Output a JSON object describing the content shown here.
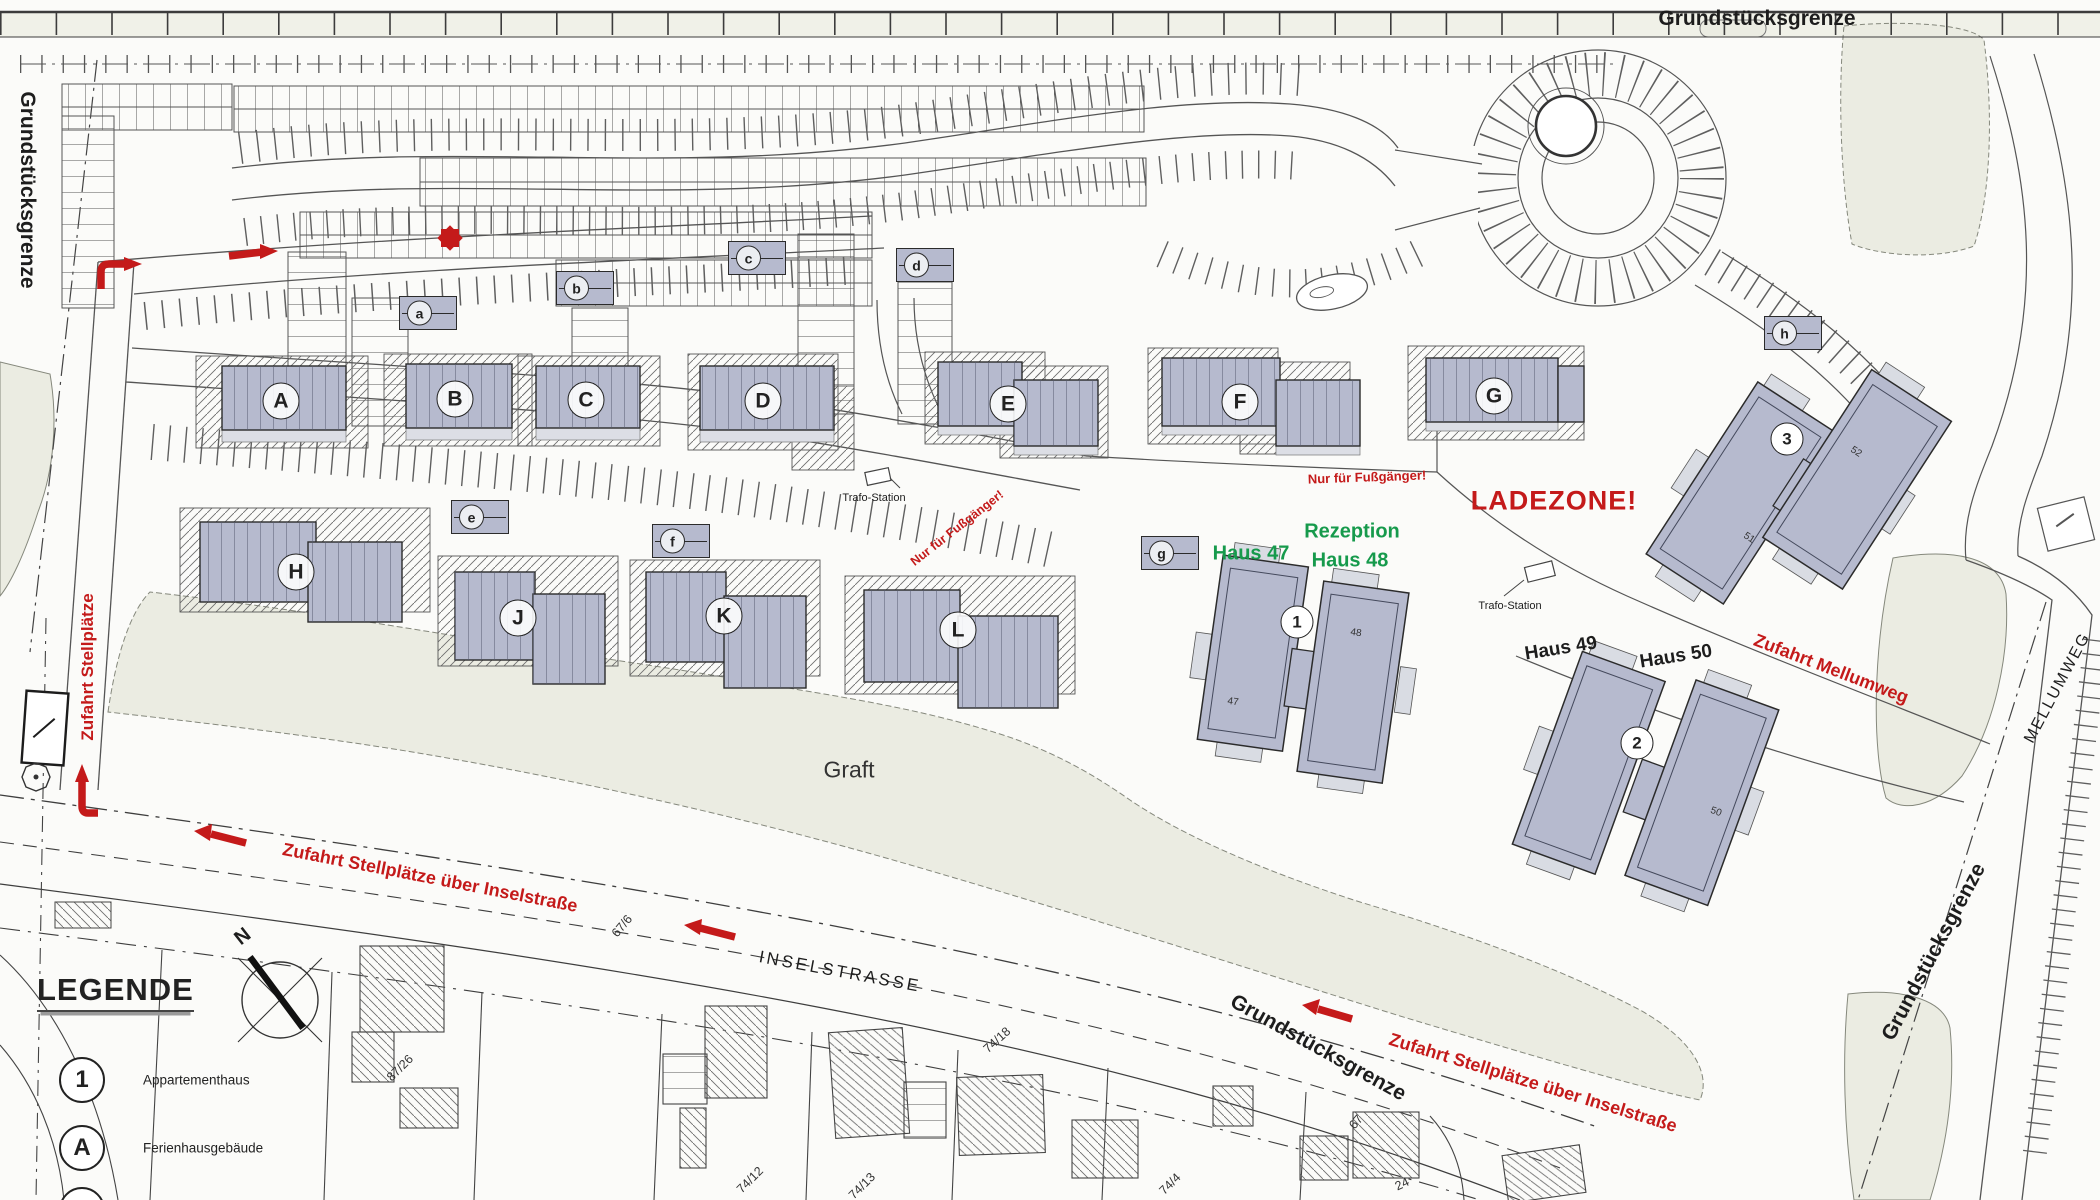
{
  "boundaries": {
    "top": "Grundstücksgrenze",
    "left": "Grundstücksgrenze",
    "bottom": "Grundstücksgrenze",
    "right": "Grundstücksgrenze"
  },
  "streets": {
    "inselstrasse": "INSELSTRASSE",
    "mellumweg": "MELLUMWEG"
  },
  "areas": {
    "graft": "Graft",
    "ladezone": "LADEZONE!"
  },
  "red_notes": {
    "zufahrt_stellplaetze": "Zufahrt Stellplätze",
    "zufahrt_inselstrasse_1": "Zufahrt Stellplätze über Inselstraße",
    "zufahrt_inselstrasse_2": "Zufahrt Stellplätze über Inselstraße",
    "zufahrt_mellumweg": "Zufahrt Mellumweg",
    "fussgaenger_1": "Nur für Fußgänger!",
    "fussgaenger_2": "Nur für Fußgänger!"
  },
  "reception": {
    "haus47": "Haus 47",
    "line1": "Rezeption",
    "line2": "Haus 48"
  },
  "houses": {
    "haus49": "Haus 49",
    "haus50": "Haus 50"
  },
  "trafo": {
    "t1": "Trafo-Station",
    "t2": "Trafo-Station"
  },
  "ferienhaus_letters": [
    "A",
    "B",
    "C",
    "D",
    "E",
    "F",
    "G",
    "H",
    "J",
    "K",
    "L"
  ],
  "apartment_numbers": [
    "1",
    "2",
    "3"
  ],
  "letter_markers": [
    "a",
    "b",
    "c",
    "d",
    "e",
    "f",
    "g",
    "h"
  ],
  "unit_numbers": {
    "h47": "47",
    "h48": "48",
    "h50": "50",
    "b51": "51",
    "b52": "52"
  },
  "parcels": [
    {
      "t": "67/6"
    },
    {
      "t": "87/26"
    },
    {
      "t": "74/18"
    },
    {
      "t": "74/12"
    },
    {
      "t": "74/13"
    },
    {
      "t": "74/4"
    },
    {
      "t": "24"
    },
    {
      "t": "67"
    }
  ],
  "legend": {
    "title": "LEGENDE",
    "items": [
      {
        "symbol": "1",
        "label": "Appartementhaus"
      },
      {
        "symbol": "A",
        "label": "Ferienhausgebäude"
      }
    ]
  },
  "compass": {
    "north": "N"
  },
  "colors": {
    "red": "#c41a1a",
    "green": "#169a4c",
    "building": "#b6bace",
    "ground": "#ebece2"
  }
}
